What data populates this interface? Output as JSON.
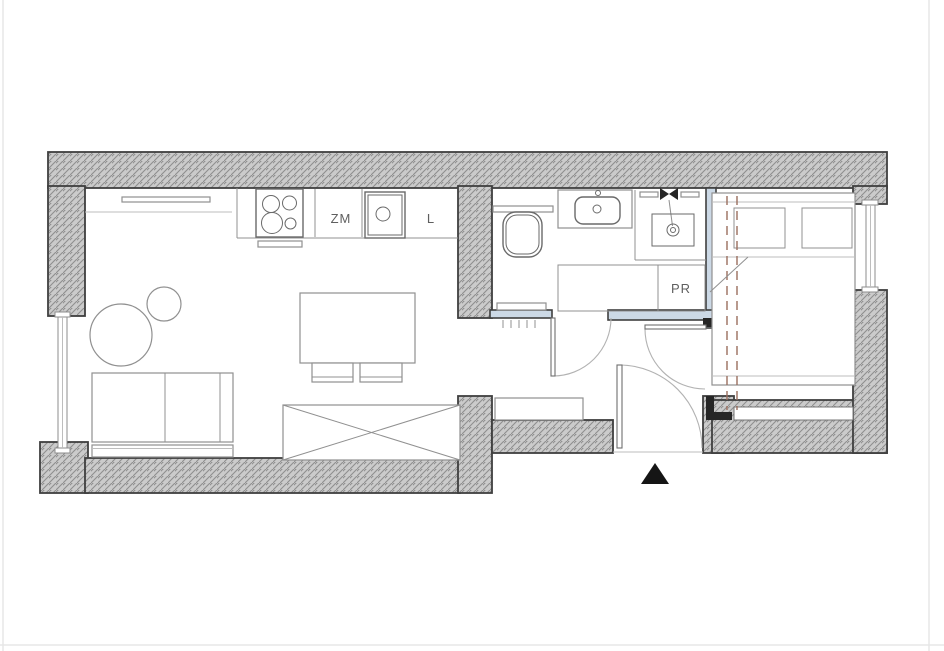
{
  "plan": {
    "labels": {
      "dishwasher": "ZM",
      "fridge": "L",
      "washing_machine": "PR"
    },
    "colors": {
      "background": "#ffffff",
      "wall_fill": "#cbcbcb",
      "wall_hatch_line": "#8e8e8e",
      "wall_outline": "#3f3f3f",
      "partition_fill": "#ccd9e6",
      "furniture_line": "#909090",
      "fixture_line": "#6a6a6a",
      "accent_dashed": "#9b6e5e",
      "entrance_marker": "#151515"
    }
  }
}
